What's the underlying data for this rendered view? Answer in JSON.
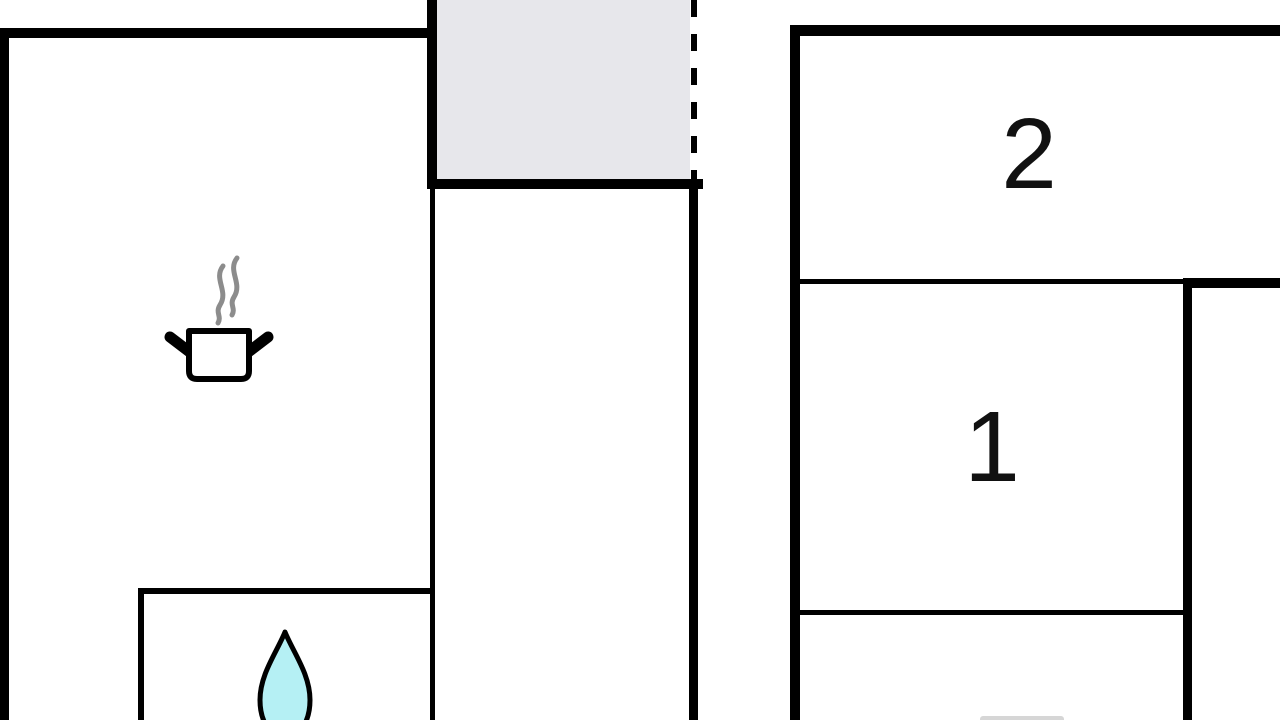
{
  "floorplan": {
    "title": "holiday-home floor plan",
    "rooms": [
      {
        "id": "bedroom-2",
        "label": "2"
      },
      {
        "id": "bedroom-1",
        "label": "1"
      },
      {
        "id": "kitchen-living",
        "label": ""
      },
      {
        "id": "bathroom",
        "label": ""
      },
      {
        "id": "terrace",
        "label": ""
      }
    ],
    "icons": {
      "cooking": "cooking-pot-with-steam-icon",
      "water": "water-drop-icon"
    },
    "colors": {
      "wall": "#000000",
      "terrace_fill": "#e7e7eb",
      "steam": "#8c8c8c",
      "water_drop_fill": "#b5f0f4",
      "icon_outline": "#000000",
      "background": "#ffffff"
    }
  }
}
